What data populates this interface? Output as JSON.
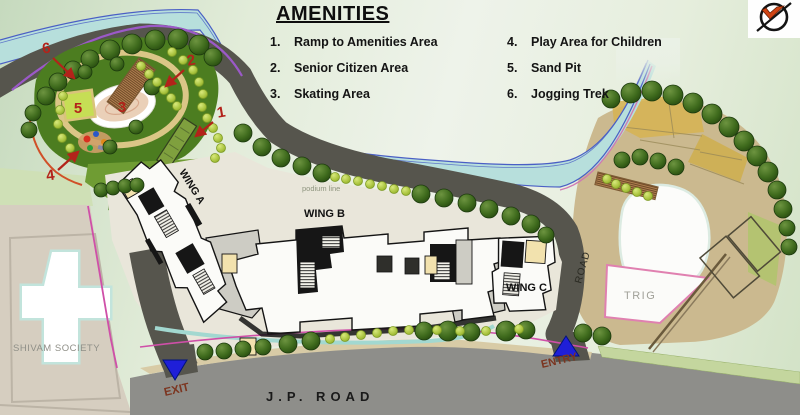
{
  "legend": {
    "title": "AMENITIES",
    "items_left": [
      {
        "num": "1.",
        "label": "Ramp to Amenities Area"
      },
      {
        "num": "2.",
        "label": "Senior Citizen Area"
      },
      {
        "num": "3.",
        "label": "Skating Area"
      }
    ],
    "items_right": [
      {
        "num": "4.",
        "label": "Play Area for Children"
      },
      {
        "num": "5.",
        "label": "Sand Pit"
      },
      {
        "num": "6.",
        "label": "Jogging Trek"
      }
    ]
  },
  "map": {
    "labels": {
      "wing_a": "WING A",
      "wing_b": "WING B",
      "wing_c": "WING C",
      "podium_line": "podium line",
      "road": "ROAD",
      "trig": "TRIG",
      "shivam_society": "SHIVAM SOCIETY",
      "jp_road": "J.P. ROAD",
      "entry": "ENTRY",
      "exit": "EXIT"
    },
    "markers": {
      "m1": "1",
      "m2": "2",
      "m3": "3",
      "m4": "4",
      "m5": "5",
      "m6": "6"
    }
  },
  "icons": {
    "logo": "compass-arrow-logo"
  },
  "colors": {
    "marker_red": "#b3231a",
    "entry_exit_text": "#7c3520",
    "gate_triangle": "#1f1fd8",
    "river": "#b7dfdc",
    "road_dark": "#56554d",
    "jp_road_gray": "#8e8e8a",
    "park_green": "#4c7d20"
  }
}
